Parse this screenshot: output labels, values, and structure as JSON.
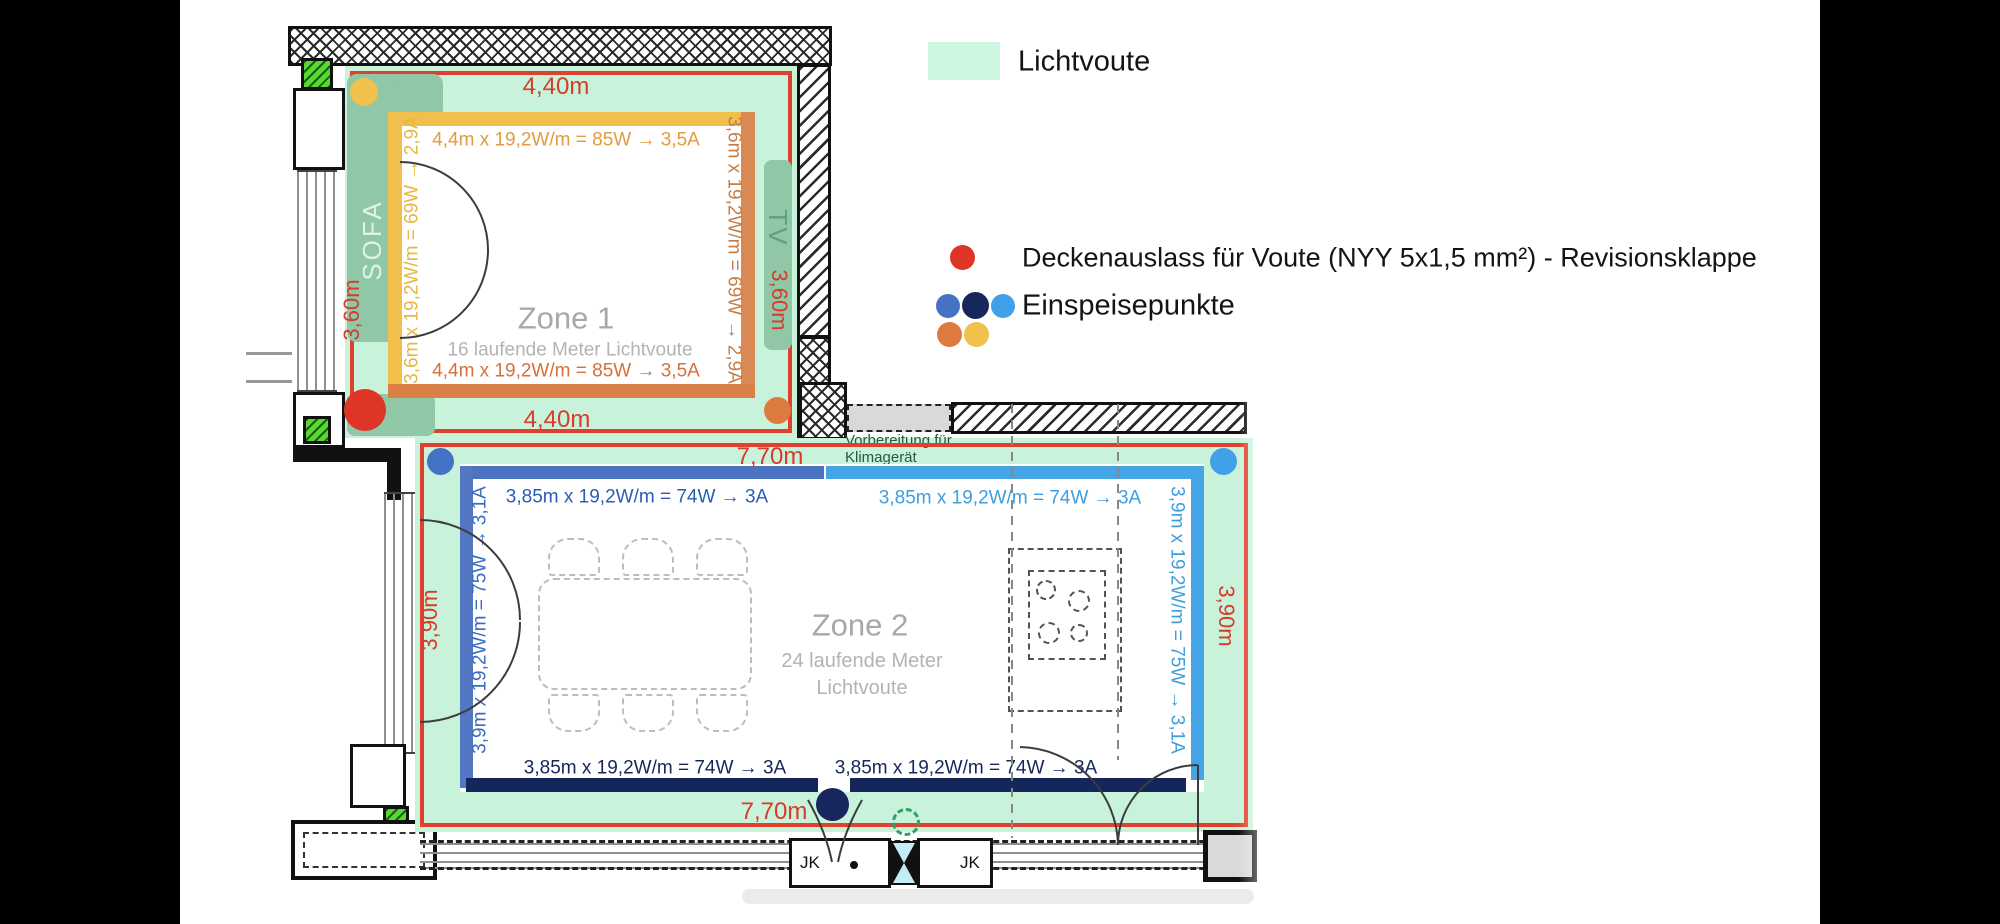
{
  "legend": {
    "lichtvoute": "Lichtvoute",
    "deckenauslass": "Deckenauslass für Voute (NYY 5x1,5 mm²) - Revisionsklappe",
    "einspeisepunkte": "Einspeisepunkte"
  },
  "zone1": {
    "title": "Zone 1",
    "subtitle": "16 laufende Meter Lichtvoute",
    "dim_top": "4,40m",
    "dim_bottom": "4,40m",
    "dim_left": "3,60m",
    "dim_right": "3,60m",
    "power_top": "4,4m x 19,2W/m = 85W → 3,5A",
    "power_bottom": "4,4m x 19,2W/m = 85W → 3,5A",
    "power_left": "3,6m x 19,2W/m = 69W → 2,9A",
    "power_right": "3,6m x 19,2W/m = 69W → 2,9A",
    "sofa": "SOFA",
    "tv": "TV"
  },
  "zone2": {
    "title": "Zone 2",
    "subtitle1": "24 laufende Meter",
    "subtitle2": "Lichtvoute",
    "dim_top": "7,70m",
    "dim_bottom": "7,70m",
    "dim_left": "3,90m",
    "dim_right": "3,90m",
    "power_top_left": "3,85m x 19,2W/m = 74W → 3A",
    "power_top_right": "3,85m x 19,2W/m = 74W → 3A",
    "power_bottom_left": "3,85m x 19,2W/m = 74W → 3A",
    "power_bottom_right": "3,85m x 19,2W/m = 74W → 3A",
    "power_left": "3,9m x 19,2W/m = 75W → 3,1A",
    "power_right": "3,9m x 19,2W/m = 75W → 3,1A",
    "note1": "Vorbereitung für",
    "note2": "Klimagerät"
  },
  "plan": {
    "jk1": "JK",
    "jk2": "JK"
  },
  "colors": {
    "lichtvoute_green": "#c9f2da",
    "legend_swatch_green": "#cdf6de",
    "deckenauslass_red": "#df3526",
    "dimension_red": "#d63c2a",
    "feed_blue": "#4472c4",
    "feed_navy": "#17265c",
    "feed_lightblue": "#42a0e8",
    "feed_orange": "#dd7b3f",
    "feed_yellow": "#f0c14b",
    "zone1_bar_yellow": "#f1bf4b",
    "zone1_bar_orange": "#d98a54",
    "zone2_bar_blue": "#4a74c2",
    "zone2_bar_lightblue": "#45a4e5",
    "zone2_bar_navy": "#15265b",
    "sofa_sage": "#8fc7a7"
  }
}
